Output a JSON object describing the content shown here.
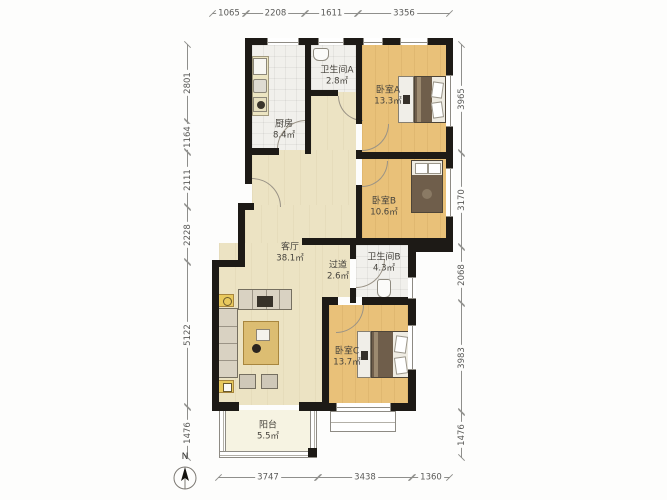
{
  "colors": {
    "wall": "#1d1a16",
    "bedroom-floor": "#e9c179",
    "living-floor": "#ece3c3",
    "wet-floor": "#f1f0ec",
    "balcony-floor": "#f6f3e2",
    "dim-line": "#8f8f8c",
    "label-text": "#45423c"
  },
  "rooms": [
    {
      "id": "kitchen",
      "name": "厨房",
      "area": "8.4㎡"
    },
    {
      "id": "bathroom-a",
      "name": "卫生间A",
      "area": "2.8㎡"
    },
    {
      "id": "bedroom-a",
      "name": "卧室A",
      "area": "13.3㎡"
    },
    {
      "id": "bedroom-b",
      "name": "卧室B",
      "area": "10.6㎡"
    },
    {
      "id": "living",
      "name": "客厅",
      "area": "38.1㎡"
    },
    {
      "id": "hallway",
      "name": "过道",
      "area": "2.6㎡"
    },
    {
      "id": "bathroom-b",
      "name": "卫生间B",
      "area": "4.3㎡"
    },
    {
      "id": "bedroom-c",
      "name": "卧室C",
      "area": "13.7㎡"
    },
    {
      "id": "balcony",
      "name": "阳台",
      "area": "5.5㎡"
    }
  ],
  "dimensions": {
    "top": [
      {
        "value": "1065",
        "from": 212,
        "to": 246
      },
      {
        "value": "2208",
        "from": 246,
        "to": 305
      },
      {
        "value": "1611",
        "from": 305,
        "to": 358
      },
      {
        "value": "3356",
        "from": 358,
        "to": 450
      }
    ],
    "bottom": [
      {
        "value": "3747",
        "from": 218,
        "to": 318
      },
      {
        "value": "3438",
        "from": 318,
        "to": 412
      },
      {
        "value": "1360",
        "from": 412,
        "to": 450
      }
    ],
    "left": [
      {
        "value": "2801",
        "from": 44,
        "to": 122
      },
      {
        "value": "1164",
        "from": 122,
        "to": 152
      },
      {
        "value": "2111",
        "from": 152,
        "to": 207
      },
      {
        "value": "2228",
        "from": 207,
        "to": 262
      },
      {
        "value": "5122",
        "from": 262,
        "to": 407
      },
      {
        "value": "1476",
        "from": 407,
        "to": 458
      }
    ],
    "right": [
      {
        "value": "3965",
        "from": 44,
        "to": 153
      },
      {
        "value": "3170",
        "from": 153,
        "to": 247
      },
      {
        "value": "2068",
        "from": 247,
        "to": 303
      },
      {
        "value": "3983",
        "from": 303,
        "to": 412
      },
      {
        "value": "1476",
        "from": 412,
        "to": 458
      }
    ]
  },
  "compass": {
    "label": "N"
  }
}
